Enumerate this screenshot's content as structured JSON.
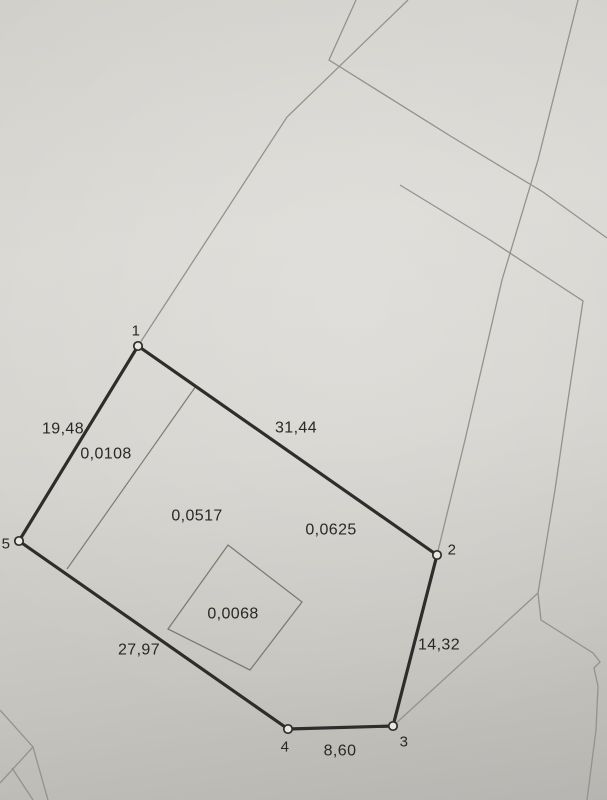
{
  "photo": {
    "paper_base_color": "#d5d3ce",
    "paper_shadow_color": "#b7b5b1",
    "boundary_line_color": "#2e2d2b",
    "thin_line_color": "#94928c",
    "inner_line_color": "#7d7b76",
    "text_color": "#292824"
  },
  "map": {
    "canvas": {
      "width": 607,
      "height": 800
    },
    "parcel": {
      "vertices": [
        {
          "id": "1",
          "x": 138,
          "y": 346,
          "label_x": 136,
          "label_y": 331
        },
        {
          "id": "2",
          "x": 437,
          "y": 555,
          "label_x": 452,
          "label_y": 550
        },
        {
          "id": "3",
          "x": 393,
          "y": 726,
          "label_x": 404,
          "label_y": 742
        },
        {
          "id": "4",
          "x": 288,
          "y": 729,
          "label_x": 285,
          "label_y": 747
        },
        {
          "id": "5",
          "x": 19,
          "y": 541,
          "label_x": 6,
          "label_y": 544
        }
      ],
      "boundary_order": [
        "1",
        "2",
        "3",
        "4",
        "5"
      ],
      "edge_labels": [
        {
          "edge": "5-1",
          "text": "19,48",
          "x": 63,
          "y": 429
        },
        {
          "edge": "1-2",
          "text": "31,44",
          "x": 296,
          "y": 428
        },
        {
          "edge": "2-3",
          "text": "14,32",
          "x": 439,
          "y": 645
        },
        {
          "edge": "3-4",
          "text": "8,60",
          "x": 340,
          "y": 751
        },
        {
          "edge": "4-5",
          "text": "27,97",
          "x": 139,
          "y": 650
        }
      ]
    },
    "area_labels": [
      {
        "text": "0,0108",
        "x": 106,
        "y": 454
      },
      {
        "text": "0,0517",
        "x": 197,
        "y": 516
      },
      {
        "text": "0,0625",
        "x": 331,
        "y": 530
      },
      {
        "text": "0,0068",
        "x": 233,
        "y": 614
      }
    ],
    "sub_parcel_outline": {
      "points": [
        [
          228,
          545
        ],
        [
          302,
          602
        ],
        [
          250,
          670
        ],
        [
          168,
          629
        ]
      ]
    },
    "divider_line": {
      "points": [
        [
          196,
          386
        ],
        [
          67,
          569
        ]
      ]
    },
    "background_lines": [
      {
        "name": "neighbor-line-vertex1-corner",
        "points": [
          [
            138,
            346
          ],
          [
            287,
            117
          ],
          [
            408,
            0
          ]
        ]
      },
      {
        "name": "neighbor-line-corridor-top",
        "points": [
          [
            356,
            0
          ],
          [
            329,
            60
          ],
          [
            452,
            137
          ],
          [
            543,
            192
          ],
          [
            607,
            238
          ]
        ]
      },
      {
        "name": "neighbor-line-corridor-bottom",
        "points": [
          [
            400,
            185
          ],
          [
            490,
            240
          ],
          [
            551,
            280
          ],
          [
            583,
            301
          ],
          [
            568,
            400
          ],
          [
            555,
            490
          ],
          [
            538,
            593
          ]
        ]
      },
      {
        "name": "neighbor-line-through-vertex2",
        "points": [
          [
            578,
            0
          ],
          [
            538,
            160
          ],
          [
            502,
            280
          ],
          [
            465,
            440
          ],
          [
            437,
            555
          ]
        ]
      },
      {
        "name": "neighbor-line-to-vertex3",
        "points": [
          [
            538,
            593
          ],
          [
            465,
            660
          ],
          [
            393,
            726
          ]
        ]
      },
      {
        "name": "neighbor-line-bottom-right",
        "points": [
          [
            538,
            593
          ],
          [
            541,
            620
          ],
          [
            593,
            653
          ],
          [
            600,
            662
          ],
          [
            594,
            668
          ],
          [
            598,
            686
          ],
          [
            596,
            730
          ],
          [
            587,
            800
          ]
        ]
      },
      {
        "name": "neighbor-line-bottom-left-v",
        "points": [
          [
            0,
            710
          ],
          [
            33,
            747
          ],
          [
            0,
            783
          ]
        ]
      },
      {
        "name": "neighbor-line-bottom-left-a",
        "points": [
          [
            33,
            747
          ],
          [
            48,
            800
          ]
        ]
      },
      {
        "name": "neighbor-line-bottom-left-b",
        "points": [
          [
            12,
            768
          ],
          [
            33,
            800
          ]
        ]
      }
    ]
  }
}
